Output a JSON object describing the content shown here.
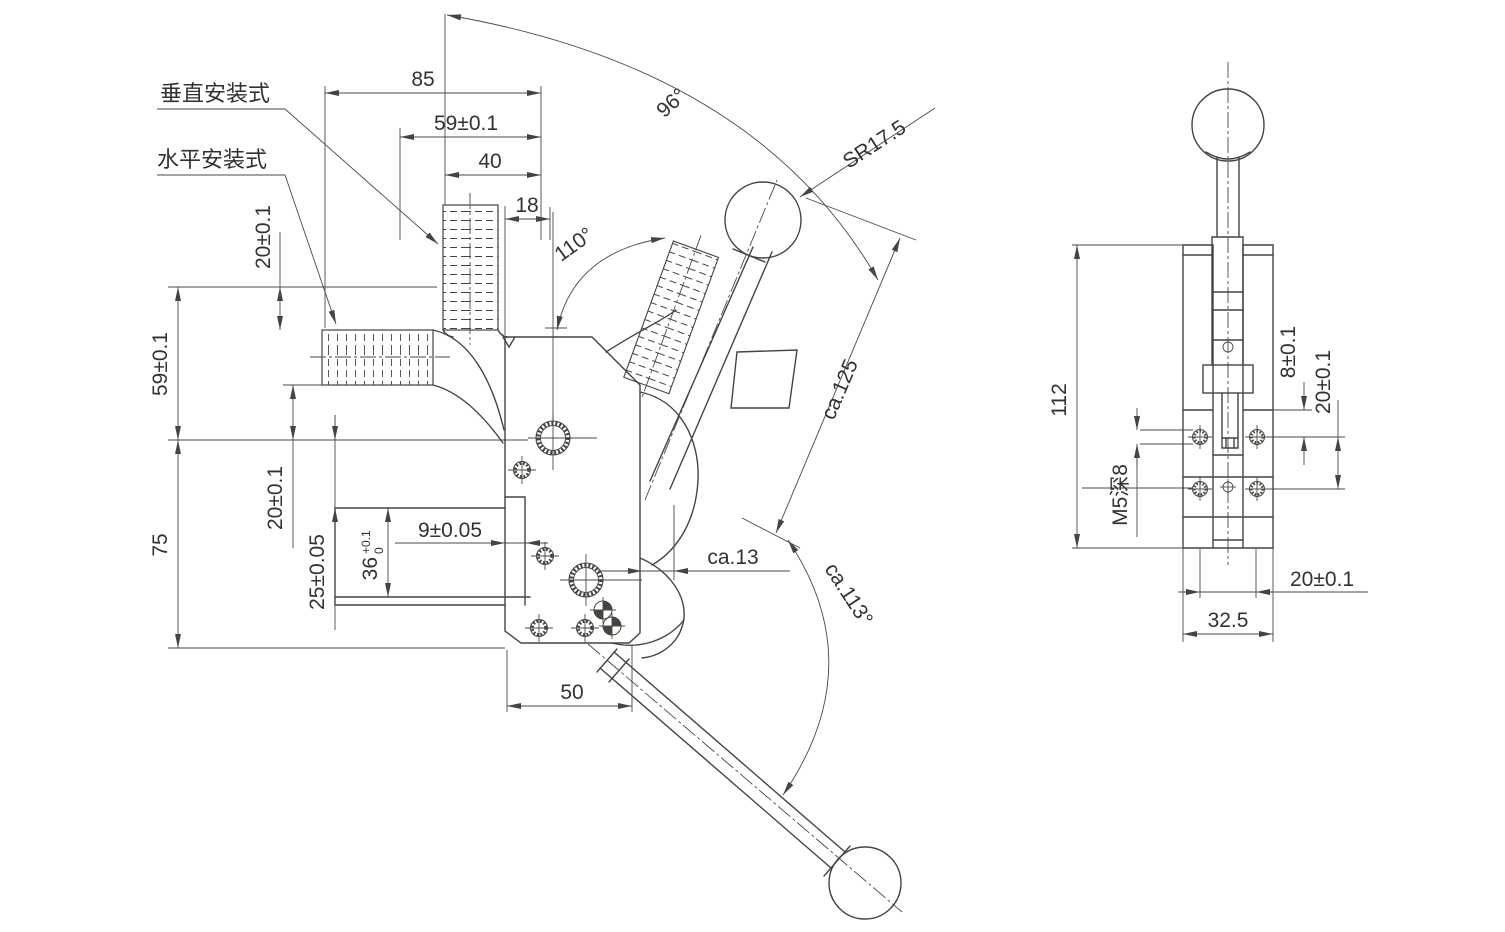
{
  "labels": {
    "vertical_mount": "垂直安装式",
    "horizontal_mount": "水平安装式"
  },
  "main_dims": {
    "d85": "85",
    "d59h": "59±0.1",
    "d40": "40",
    "d18": "18",
    "a96": "96°",
    "a110": "110°",
    "sr": "SR17.5",
    "d20_top": "20±0.1",
    "d59v": "59±0.1",
    "d20_mid": "20±0.1",
    "d75": "75",
    "d25": "25±0.05",
    "d36": "36",
    "d36_tol_upper": "+0.1",
    "d36_tol_lower": "0",
    "d9": "9±0.05",
    "ca13": "ca.13",
    "ca125": "ca.125",
    "ca113": "ca.113°",
    "d50": "50"
  },
  "side_dims": {
    "d112": "112",
    "d8": "8±0.1",
    "d20_right": "20±0.1",
    "m5": "M5深8",
    "d20_bottom": "20±0.1",
    "d325": "32.5"
  }
}
